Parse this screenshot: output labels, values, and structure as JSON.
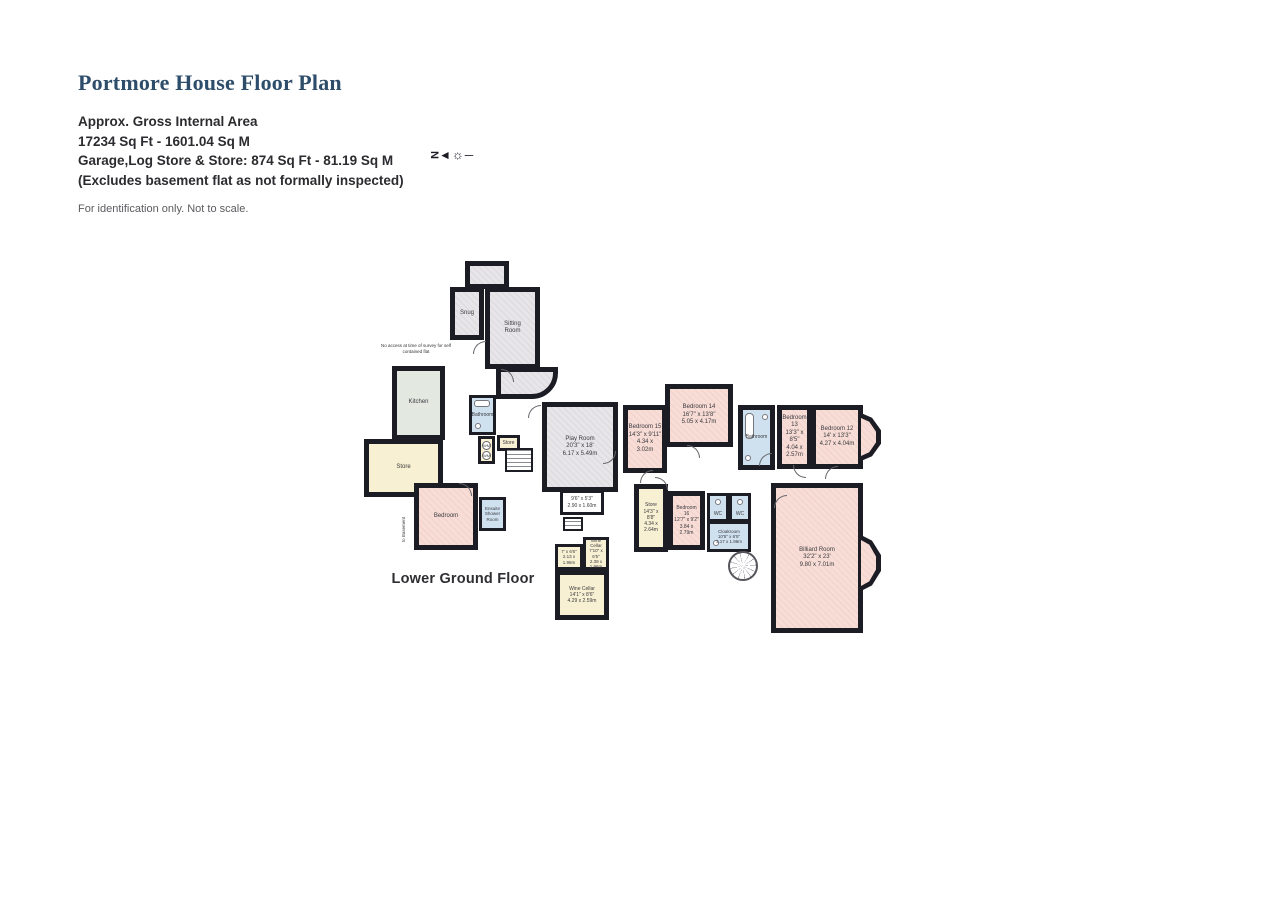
{
  "header": {
    "title": "Portmore House Floor Plan",
    "line1": "Approx. Gross Internal Area",
    "line2": "17234 Sq Ft - 1601.04 Sq M",
    "line3": "Garage,Log Store & Store: 874 Sq Ft - 81.19 Sq M",
    "line4": "(Excludes basement flat as not formally inspected)",
    "disclaimer": "For identification only. Not to scale.",
    "compass": {
      "letter": "N",
      "arrow": "◄",
      "sun": "☼",
      "dash": "─"
    }
  },
  "floor": {
    "label": "Lower Ground Floor"
  },
  "notes": {
    "no_access": "No access at time of survey for self contained flat",
    "to_basement": "to Basement"
  },
  "colors": {
    "wall": "#1c1c25",
    "bedroom_fill": "#f8ddd6",
    "store_fill": "#f8f0d2",
    "bathroom_fill": "#cfe0ee",
    "reception_fill": "#e7e5e8",
    "kitchen_fill": "#e3e8e0",
    "title_text": "#2e4d6b"
  },
  "rooms": {
    "snug": {
      "name": "Snug"
    },
    "sitting": {
      "name": "Sitting Room"
    },
    "kitchen": {
      "name": "Kitchen"
    },
    "store_left": {
      "name": "Store"
    },
    "bedroom_flat": {
      "name": "Bedroom"
    },
    "ensuite": {
      "name": "Ensuite Shower Room"
    },
    "bathroom_center": {
      "name": "Bathroom"
    },
    "store_small": {
      "name": "Store"
    },
    "play_room": {
      "name": "Play Room",
      "ft": "20'3\" x 18'",
      "m": "6.17 x 5.49m"
    },
    "room_9_6": {
      "ft": "9'6\" x 5'3\"",
      "m": "2.90 x 1.60m"
    },
    "cellar_a": {
      "ft": "7' x 6'6\"",
      "m": "2.13 x 1.98m"
    },
    "wine_cellar_small": {
      "name": "Wine Cellar",
      "ft": "7'10\" x 6'5\"",
      "m": "2.39 x 1.96m"
    },
    "wine_cellar": {
      "name": "Wine Cellar",
      "ft": "14'1\" x 8'6\"",
      "m": "4.29 x 2.59m"
    },
    "bedroom_15": {
      "name": "Bedroom 15",
      "ft": "14'3\" x 9'11\"",
      "m": "4.34 x 3.02m"
    },
    "bedroom_14": {
      "name": "Bedroom 14",
      "ft": "16'7\" x 13'8\"",
      "m": "5.05 x 4.17m"
    },
    "bathroom_right": {
      "name": "Bathroom"
    },
    "bedroom_13": {
      "name": "Bedroom 13",
      "ft": "13'3\" x 8'5\"",
      "m": "4.04 x 2.57m"
    },
    "bedroom_12": {
      "name": "Bedroom 12",
      "ft": "14' x 13'3\"",
      "m": "4.27 x 4.04m"
    },
    "store_lower": {
      "name": "Store",
      "ft": "14'3\" x 8'8\"",
      "m": "4.34 x 2.64m"
    },
    "bedroom_16": {
      "name": "Bedroom 16",
      "ft": "12'7\" x 9'2\"",
      "m": "3.84 x 2.79m"
    },
    "wc1": {
      "name": "WC"
    },
    "wc2": {
      "name": "WC"
    },
    "cloakroom": {
      "name": "Cloakroom",
      "ft": "10'5\" x 6'5\"",
      "m": "3.17 x 1.96m"
    },
    "billiard": {
      "name": "Billiard Room",
      "ft": "32'2\" x 23'",
      "m": "9.80 x 7.01m"
    },
    "wm": "WM"
  }
}
